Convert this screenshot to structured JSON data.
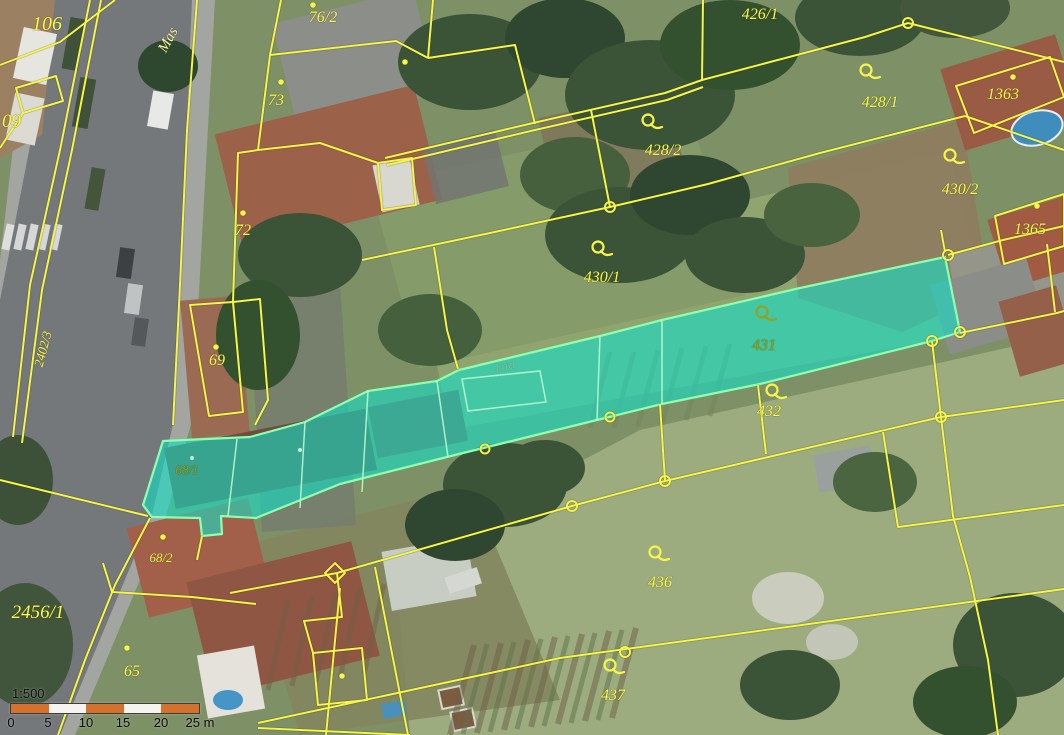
{
  "map": {
    "street": {
      "name": "Mas"
    },
    "place_name": "Lázi",
    "parcels": {
      "p106": "106",
      "p09": "09",
      "p76_2": "76/2",
      "p73": "73",
      "p72": "72",
      "p69": "69",
      "p2402_3": "2402/3",
      "p426_1": "426/1",
      "p428_1": "428/1",
      "p428_2": "428/2",
      "p1363": "1363",
      "p430_2": "430/2",
      "p1365": "1365",
      "p430_1": "430/1",
      "p431": "431",
      "p432": "432",
      "p68_1": "68/1",
      "p68_2": "68/2",
      "p2456_1": "2456/1",
      "p65": "65",
      "p436": "436",
      "p437": "437"
    },
    "colors": {
      "boundary": "#f6f64a",
      "highlight_fill": "#12dfc6",
      "highlight_stroke": "#8dffae",
      "label": "#fbfb4f",
      "label_on_highlight": "#93a31e"
    }
  },
  "scalebar": {
    "ratio": "1:500",
    "ticks": [
      "0",
      "5",
      "10",
      "15",
      "20",
      "25 m"
    ],
    "bar_color": "#d4712d"
  }
}
